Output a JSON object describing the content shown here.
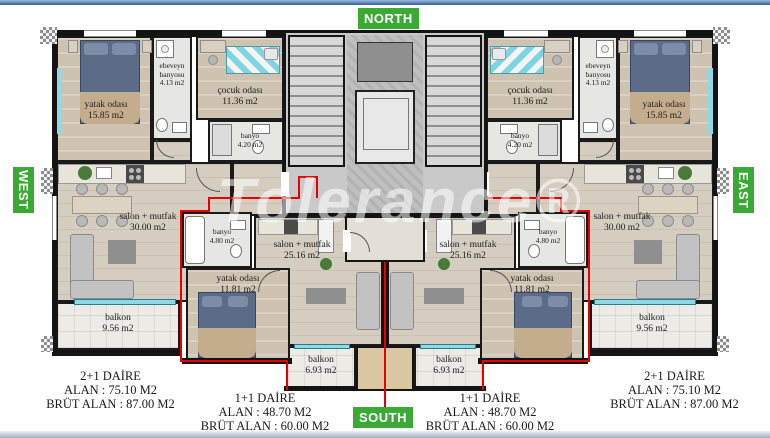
{
  "watermark": "Tolerance®",
  "compass": {
    "north": "NORTH",
    "south": "SOUTH",
    "west": "WEST",
    "east": "EAST"
  },
  "rooms": {
    "yatak_odasi_buyuk": {
      "name": "yatak odası",
      "area": "15.85 m2"
    },
    "cocuk_odasi": {
      "name": "çocuk odası",
      "area": "11.36 m2"
    },
    "ebeveyn_banyosu": {
      "name": "ebeveyn banyosu",
      "area": "4.13 m2"
    },
    "banyo_buyuk": {
      "name": "banyo",
      "area": "4.20 m2"
    },
    "salon_buyuk": {
      "name": "salon + mutfak",
      "area": "30.00 m2"
    },
    "balkon_buyuk": {
      "name": "balkon",
      "area": "9.56 m2"
    },
    "banyo_kucuk": {
      "name": "banyo",
      "area": "4.80 m2"
    },
    "yatak_odasi_kucuk": {
      "name": "yatak odası",
      "area": "11.81 m2"
    },
    "salon_kucuk": {
      "name": "salon + mutfak",
      "area": "25.16 m2"
    },
    "balkon_kucuk": {
      "name": "balkon",
      "area": "6.93 m2"
    }
  },
  "summaries": {
    "left_2p1": {
      "title": "2+1 DAİRE",
      "alan": "ALAN : 75.10 M2",
      "brut": "BRÜT ALAN : 87.00 M2"
    },
    "left_1p1": {
      "title": "1+1 DAİRE",
      "alan": "ALAN : 48.70 M2",
      "brut": "BRÜT ALAN : 60.00 M2"
    },
    "right_1p1": {
      "title": "1+1 DAİRE",
      "alan": "ALAN : 48.70 M2",
      "brut": "BRÜT ALAN : 60.00 M2"
    },
    "right_2p1": {
      "title": "2+1 DAİRE",
      "alan": "ALAN : 75.10 M2",
      "brut": "BRÜT ALAN : 87.00 M2"
    }
  },
  "colors": {
    "badge_green": "#3aaa35",
    "unit_line_red": "#e60000",
    "window_cyan": "#8fd9e6"
  }
}
